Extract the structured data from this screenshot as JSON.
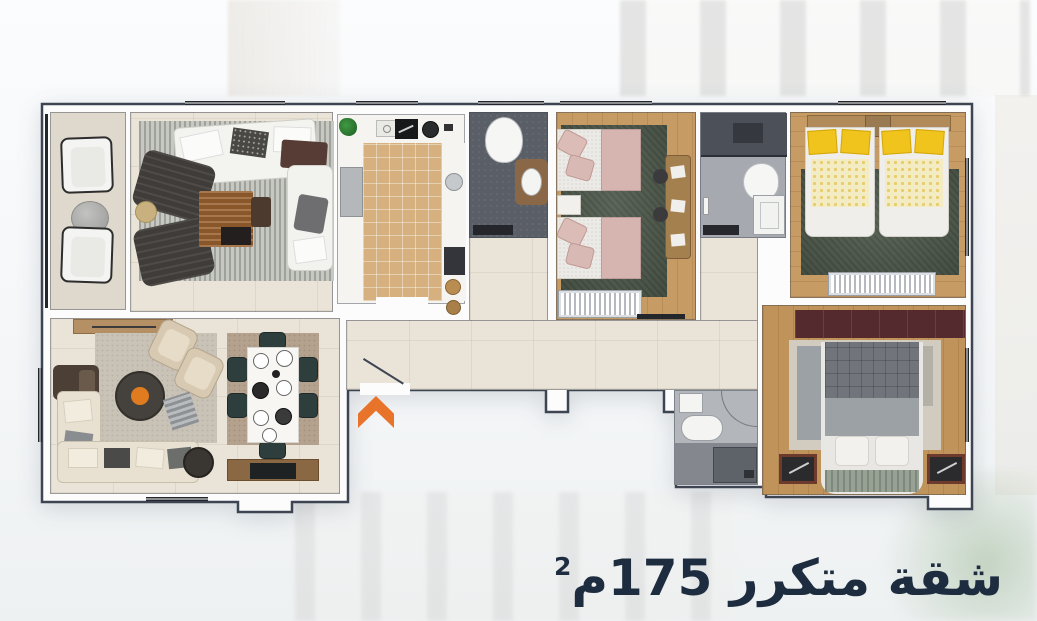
{
  "title": {
    "text": "شقة متكرر 175م",
    "superscript": "2",
    "color": "#1e2c3f"
  },
  "plan": {
    "outline_color": "#3d4452",
    "wall_color": "#fcfcfd",
    "entrance_arrow_color": "#e8742b",
    "floor_colors": {
      "tile_beige": "#eae3d7",
      "balcony": "#dfd9cd",
      "kitchen_tile": "#d6b07e",
      "wood": "#c79b64",
      "bath_dark": "#5a5f67",
      "bath_light": "#a6aab0",
      "rug_green": "#505b4d"
    },
    "rooms": [
      {
        "id": "balcony",
        "furniture": [
          "outdoor-chair",
          "stone-table",
          "outdoor-chair"
        ]
      },
      {
        "id": "living-room",
        "furniture": [
          "striped-rug",
          "sofa",
          "armchair",
          "armchair",
          "wood-coffee-table",
          "chaise",
          "side-table"
        ]
      },
      {
        "id": "kitchen",
        "furniture": [
          "plant",
          "cooktop",
          "pan",
          "fridge",
          "sink",
          "oven",
          "pots"
        ]
      },
      {
        "id": "bathroom-1",
        "furniture": [
          "toilet",
          "vanity-sink",
          "bath-mat"
        ]
      },
      {
        "id": "bedroom-1",
        "furniture": [
          "green-rug",
          "twin-bed",
          "twin-bed",
          "nightstand",
          "desk",
          "stool",
          "stool",
          "radiator"
        ]
      },
      {
        "id": "bathroom-2",
        "furniture": [
          "shower",
          "toilet",
          "shower-tray",
          "bath-mat"
        ]
      },
      {
        "id": "bedroom-2",
        "furniture": [
          "green-rug",
          "headboard",
          "nightstand",
          "twin-bed-yellow",
          "twin-bed-yellow",
          "radiator"
        ]
      },
      {
        "id": "hallway",
        "furniture": []
      },
      {
        "id": "living-dining-room",
        "furniture": [
          "tv-console",
          "gray-rug",
          "lounge-chair",
          "lounge-chair",
          "armchair",
          "round-coffee-table",
          "sectional-sofa",
          "pouf",
          "dining-rug",
          "dining-table",
          "dining-chair",
          "dining-chair",
          "dining-chair",
          "dining-chair",
          "dining-chair",
          "dining-chair",
          "sideboard"
        ]
      },
      {
        "id": "bathroom-3",
        "furniture": [
          "sink",
          "tub",
          "shower-tray"
        ]
      },
      {
        "id": "bedroom-3",
        "furniture": [
          "wardrobe",
          "rug",
          "double-bed",
          "bench",
          "nightstand",
          "nightstand"
        ]
      }
    ]
  }
}
